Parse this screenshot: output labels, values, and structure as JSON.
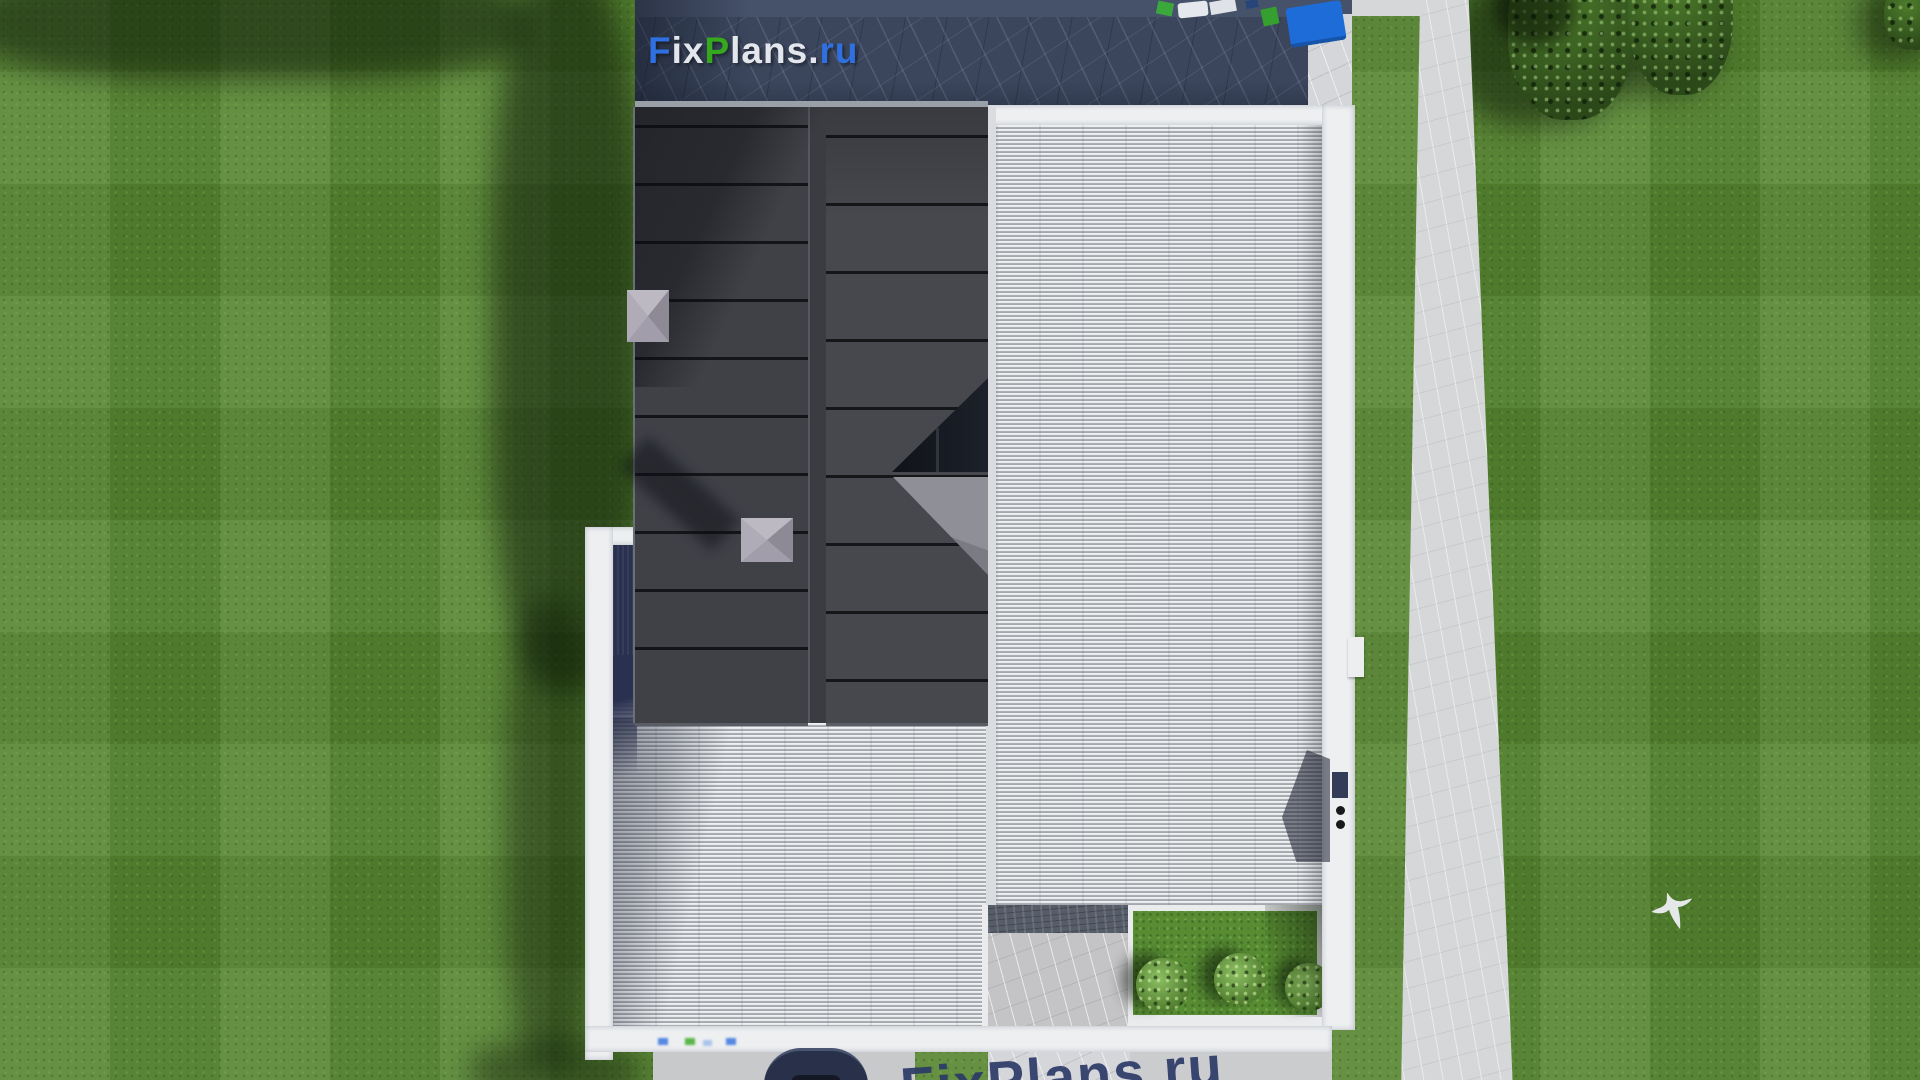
{
  "brand": {
    "logo_text": "FixPlans.ru",
    "logo_parts": {
      "f": "F",
      "ix": "ix",
      "p": "P",
      "lans": "lans",
      "dot": ".",
      "ru": "ru"
    },
    "logo_colors": {
      "blue": "#2f6fe0",
      "green": "#35a81e",
      "light": "#e3e6ec"
    },
    "bottom_watermark_text": "FixPlans.ru",
    "bottom_watermark_color": "#2b3a68"
  },
  "scene": {
    "description": "Top-down aerial 3D render of a modern house: dark standing-seam metal roof joined to a light striped flat deck roof inside white parapet walls, shaded stone patio at top, garden path at right, lawn with mowing pattern, trees, inner courtyard with stone pad and three bushes, navy car on driveway at bottom, white bird flying over the lawn",
    "colors": {
      "lawn": "#578631",
      "dark_roof": "#43454b",
      "flat_roof": "#b3b6bb",
      "parapet": "#edeff1",
      "patio_stone": "#3b465d",
      "path": "#d6d7d9",
      "car": "#28304a",
      "foliage": "#35571f"
    },
    "elements": [
      "shaded stone patio",
      "toy blocks on patio",
      "standing-seam dark metal roof",
      "two faceted roof chimneys",
      "corner skylight glazing",
      "striped flat roof deck",
      "white parapet wall",
      "roof hatch shadow",
      "parapet vent dots",
      "courtyard stone pad",
      "courtyard lawn with three bushes",
      "garden path",
      "driveway",
      "navy car",
      "flying bird",
      "two trees"
    ]
  }
}
